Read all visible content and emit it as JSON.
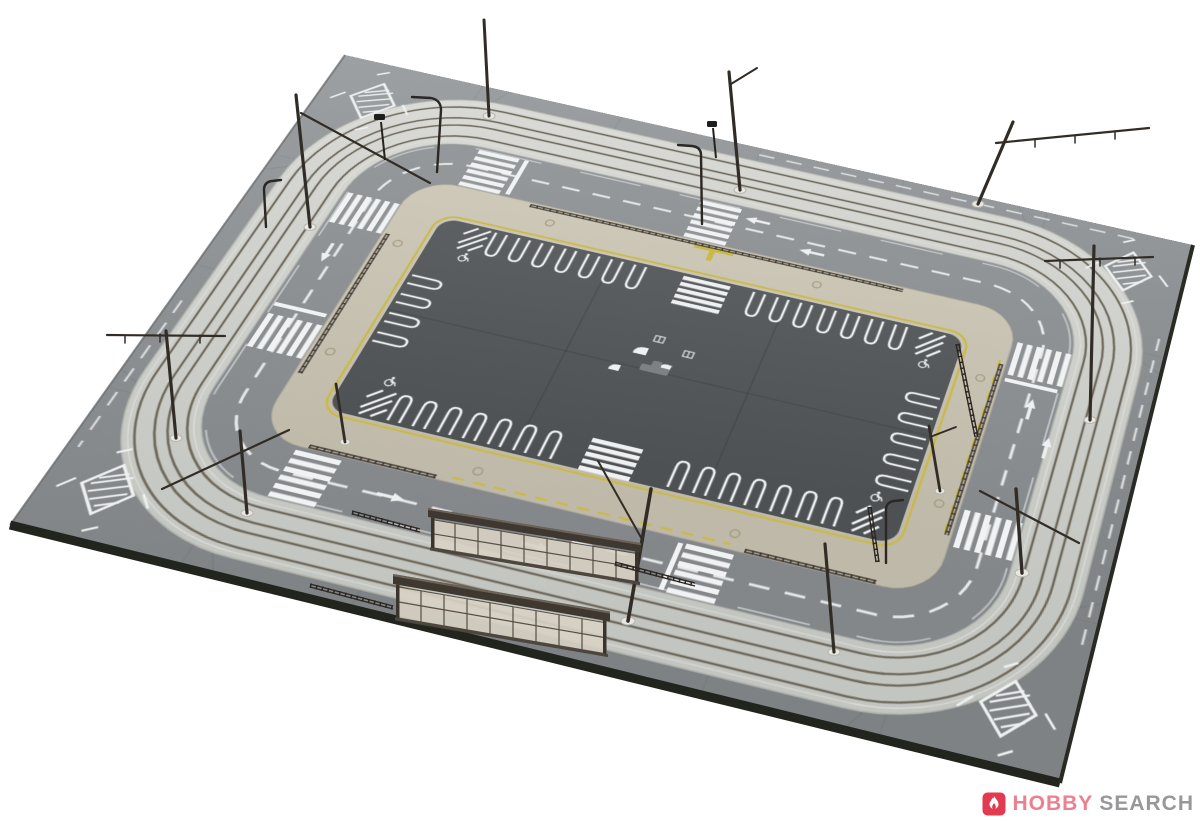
{
  "watermark": {
    "logo_icon": "flame-icon",
    "brand": "HOBBY",
    "suffix": "SEARCH"
  },
  "palette": {
    "background": "#ffffff",
    "road_gray": "#8f9295",
    "track_paving": "#d2d4cf",
    "rail_brown": "#6e695c",
    "sidewalk_beige": "#c9c3b3",
    "parking_dark": "#55585b",
    "marking_white": "#f0f2f3",
    "marking_yellow": "#c9ba45",
    "pole_dark": "#322c26",
    "board_edge_dark": "#21251d",
    "logo_red": "#e23b50",
    "brand_pink": "#ed7f8e",
    "brand_gray": "#98989b"
  },
  "scene": {
    "subject": "model tram diorama with oval double track, road plates and central parking lot",
    "tram_stop_shelters": 2,
    "catenary_poles": 12,
    "street_lamps": 4,
    "corner_diamond_markings": 4,
    "crosswalks": 8
  }
}
